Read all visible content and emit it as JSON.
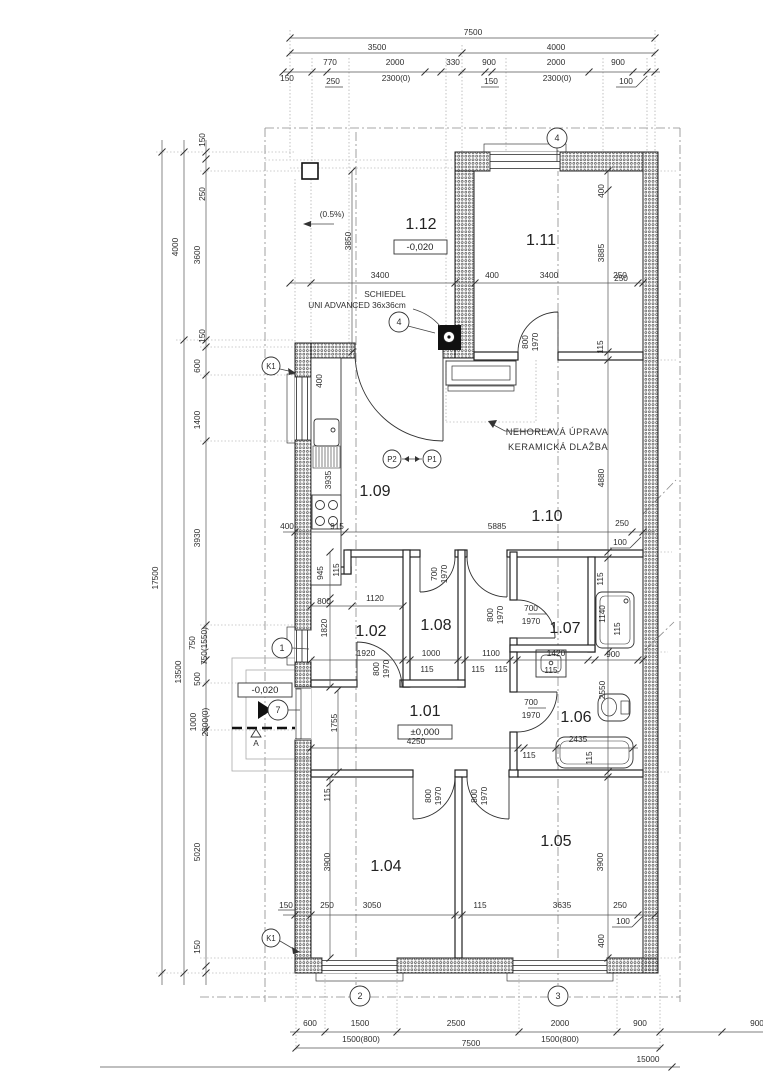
{
  "drawing": {
    "kind": "architectural floor plan",
    "levels": {
      "main": "±0,000",
      "terrace": "-0,020",
      "porch": "-0,020"
    },
    "colors": {
      "lines": "#2e2e2e",
      "walls": "#555555",
      "background": "#ffffff"
    }
  },
  "rooms": [
    {
      "number": "1.01",
      "level": "±0,000"
    },
    {
      "number": "1.02"
    },
    {
      "number": "1.04"
    },
    {
      "number": "1.05"
    },
    {
      "number": "1.06"
    },
    {
      "number": "1.07"
    },
    {
      "number": "1.08"
    },
    {
      "number": "1.09"
    },
    {
      "number": "1.10"
    },
    {
      "number": "1.11"
    },
    {
      "number": "1.12",
      "level": "-0,020"
    }
  ],
  "annotations": {
    "chimney": [
      "SCHIEDEL",
      "UNI ADVANCED 36x36cm"
    ],
    "fireproof": [
      "NEHORĽAVÁ ÚPRAVA",
      "KERAMICKÁ DLAŽBA"
    ],
    "slope": "(0.5%)",
    "section_letter": "A"
  },
  "markers": [
    {
      "n": "axis-marker-4-top",
      "t": "4",
      "x": 557,
      "y": 138
    },
    {
      "n": "detail-marker-4-chimney",
      "t": "4",
      "x": 399,
      "y": 322
    },
    {
      "n": "detail-marker-k1-top",
      "t": "K1",
      "x": 271,
      "y": 366,
      "sm": 1
    },
    {
      "n": "axis-marker-1",
      "t": "1",
      "x": 282,
      "y": 648
    },
    {
      "n": "entry-marker-7",
      "t": "7",
      "x": 278,
      "y": 710
    },
    {
      "n": "detail-marker-k1-bottom",
      "t": "K1",
      "x": 271,
      "y": 938,
      "sm": 1
    },
    {
      "n": "axis-marker-2",
      "t": "2",
      "x": 360,
      "y": 996
    },
    {
      "n": "axis-marker-3",
      "t": "3",
      "x": 558,
      "y": 996
    },
    {
      "n": "section-marker-p2",
      "t": "P2",
      "x": 392,
      "y": 459,
      "sm": 1
    },
    {
      "n": "section-marker-p1",
      "t": "P1",
      "x": 432,
      "y": 459,
      "sm": 1
    }
  ],
  "labels": [
    {
      "n": "dim-top-overall",
      "t": "7500",
      "x": 473,
      "y": 35
    },
    {
      "n": "dim-top",
      "t": "3500",
      "x": 377,
      "y": 50
    },
    {
      "n": "dim-top",
      "t": "4000",
      "x": 556,
      "y": 50
    },
    {
      "n": "dim-top",
      "t": "770",
      "x": 330,
      "y": 65
    },
    {
      "n": "dim-top",
      "t": "2000",
      "x": 395,
      "y": 65
    },
    {
      "n": "dim-top",
      "t": "330",
      "x": 453,
      "y": 65
    },
    {
      "n": "dim-top",
      "t": "900",
      "x": 489,
      "y": 65
    },
    {
      "n": "dim-top",
      "t": "2000",
      "x": 556,
      "y": 65
    },
    {
      "n": "dim-top",
      "t": "900",
      "x": 618,
      "y": 65
    },
    {
      "n": "dim-top",
      "t": "150",
      "x": 287,
      "y": 81
    },
    {
      "n": "dim-top",
      "t": "250",
      "x": 333,
      "y": 84
    },
    {
      "n": "dim-top-window",
      "t": "2300(0)",
      "x": 396,
      "y": 81
    },
    {
      "n": "dim-top",
      "t": "150",
      "x": 491,
      "y": 84
    },
    {
      "n": "dim-top-window",
      "t": "2300(0)",
      "x": 557,
      "y": 81
    },
    {
      "n": "dim-top",
      "t": "100",
      "x": 626,
      "y": 84
    },
    {
      "n": "dim-left",
      "t": "150",
      "x": 205,
      "y": 140,
      "r": -90
    },
    {
      "n": "dim-left",
      "t": "250",
      "x": 205,
      "y": 194,
      "r": -90
    },
    {
      "n": "dim-left",
      "t": "4000",
      "x": 178,
      "y": 247,
      "r": -90
    },
    {
      "n": "dim-left",
      "t": "3600",
      "x": 200,
      "y": 255,
      "r": -90
    },
    {
      "n": "dim-left",
      "t": "150",
      "x": 205,
      "y": 336,
      "r": -90
    },
    {
      "n": "dim-left",
      "t": "600",
      "x": 200,
      "y": 366,
      "r": -90
    },
    {
      "n": "dim-left",
      "t": "1400",
      "x": 200,
      "y": 420,
      "r": -90
    },
    {
      "n": "dim-left-overall",
      "t": "17500",
      "x": 158,
      "y": 578,
      "r": -90
    },
    {
      "n": "dim-left",
      "t": "13500",
      "x": 181,
      "y": 672,
      "r": -90
    },
    {
      "n": "dim-left",
      "t": "3930",
      "x": 200,
      "y": 538,
      "r": -90
    },
    {
      "n": "dim-left",
      "t": "750",
      "x": 195,
      "y": 643,
      "r": -90
    },
    {
      "n": "dim-left-window",
      "t": "750(1550)",
      "x": 207,
      "y": 646,
      "r": -90,
      "s": 7.5
    },
    {
      "n": "dim-left",
      "t": "500",
      "x": 200,
      "y": 679,
      "r": -90
    },
    {
      "n": "dim-left",
      "t": "1000",
      "x": 196,
      "y": 722,
      "r": -90
    },
    {
      "n": "dim-left-door",
      "t": "2300(0)",
      "x": 208,
      "y": 722,
      "r": -90,
      "s": 7.5
    },
    {
      "n": "dim-left",
      "t": "5020",
      "x": 200,
      "y": 852,
      "r": -90
    },
    {
      "n": "dim-left",
      "t": "150",
      "x": 200,
      "y": 947,
      "r": -90
    },
    {
      "n": "dim-right",
      "t": "400",
      "x": 604,
      "y": 191,
      "r": -90
    },
    {
      "n": "dim-right",
      "t": "3885",
      "x": 604,
      "y": 253,
      "r": -90
    },
    {
      "n": "dim-right",
      "t": "250",
      "x": 621,
      "y": 281
    },
    {
      "n": "dim-right",
      "t": "115",
      "x": 603,
      "y": 347,
      "r": -90
    },
    {
      "n": "dim-right",
      "t": "4880",
      "x": 604,
      "y": 478,
      "r": -90
    },
    {
      "n": "dim-right",
      "t": "250",
      "x": 622,
      "y": 526
    },
    {
      "n": "dim-right",
      "t": "100",
      "x": 620,
      "y": 545
    },
    {
      "n": "dim-right",
      "t": "115",
      "x": 603,
      "y": 579,
      "r": -90
    },
    {
      "n": "dim-fixture",
      "t": "1140",
      "x": 605,
      "y": 614,
      "r": -90
    },
    {
      "n": "dim-right",
      "t": "115",
      "x": 620,
      "y": 629,
      "r": -90
    },
    {
      "n": "dim-right",
      "t": "900",
      "x": 613,
      "y": 657
    },
    {
      "n": "dim-right",
      "t": "2550",
      "x": 605,
      "y": 690,
      "r": -90
    },
    {
      "n": "dim-right",
      "t": "3900",
      "x": 603,
      "y": 862,
      "r": -90
    },
    {
      "n": "dim-right",
      "t": "250",
      "x": 620,
      "y": 908
    },
    {
      "n": "dim-right",
      "t": "100",
      "x": 623,
      "y": 924
    },
    {
      "n": "dim-right",
      "t": "400",
      "x": 604,
      "y": 941,
      "r": -90
    },
    {
      "n": "slope-label",
      "t": "(0.5%)",
      "x": 332,
      "y": 217,
      "s": 7.5
    },
    {
      "n": "dim-terrace",
      "t": "3850",
      "x": 351,
      "y": 241,
      "r": -90
    },
    {
      "n": "dim-row",
      "t": "3400",
      "x": 380,
      "y": 278
    },
    {
      "n": "dim-row",
      "t": "400",
      "x": 492,
      "y": 278
    },
    {
      "n": "dim-row",
      "t": "3400",
      "x": 549,
      "y": 278
    },
    {
      "n": "dim-row",
      "t": "250",
      "x": 620,
      "y": 278
    },
    {
      "n": "chimney-label-1",
      "t": "SCHIEDEL",
      "x": 385,
      "y": 297,
      "s": 8.2
    },
    {
      "n": "chimney-label-2",
      "t": "UNI ADVANCED 36x36cm",
      "x": 357,
      "y": 308,
      "s": 8.2
    },
    {
      "n": "door-dim",
      "t": "800",
      "x": 528,
      "y": 342,
      "r": -90
    },
    {
      "n": "door-dim",
      "t": "1970",
      "x": 538,
      "y": 342,
      "r": -90
    },
    {
      "n": "fireproof-label-1",
      "t": "NEHORĽAVÁ ÚPRAVA",
      "x": 557,
      "y": 435,
      "c": "ann"
    },
    {
      "n": "fireproof-label-2",
      "t": "KERAMICKÁ DLAŽBA",
      "x": 558,
      "y": 450,
      "c": "ann"
    },
    {
      "n": "dim-kitchen",
      "t": "400",
      "x": 322,
      "y": 381,
      "r": -90
    },
    {
      "n": "dim-kitchen",
      "t": "3935",
      "x": 331,
      "y": 480,
      "r": -90
    },
    {
      "n": "dim-row",
      "t": "400",
      "x": 287,
      "y": 529
    },
    {
      "n": "dim-row",
      "t": "915",
      "x": 337,
      "y": 529
    },
    {
      "n": "dim-row",
      "t": "5885",
      "x": 497,
      "y": 529
    },
    {
      "n": "dim-mid",
      "t": "945",
      "x": 323,
      "y": 573,
      "r": -90
    },
    {
      "n": "dim-mid",
      "t": "115",
      "x": 339,
      "y": 570,
      "r": -90
    },
    {
      "n": "dim-mid",
      "t": "800",
      "x": 324,
      "y": 604
    },
    {
      "n": "dim-mid",
      "t": "1120",
      "x": 375,
      "y": 601
    },
    {
      "n": "dim-mid",
      "t": "1820",
      "x": 327,
      "y": 628,
      "r": -90
    },
    {
      "n": "door-dim",
      "t": "700",
      "x": 437,
      "y": 574,
      "r": -90
    },
    {
      "n": "door-dim",
      "t": "1970",
      "x": 447,
      "y": 574,
      "r": -90
    },
    {
      "n": "door-dim",
      "t": "800",
      "x": 493,
      "y": 615,
      "r": -90
    },
    {
      "n": "door-dim",
      "t": "1970",
      "x": 503,
      "y": 615,
      "r": -90
    },
    {
      "n": "door-dim",
      "t": "700",
      "x": 531,
      "y": 611
    },
    {
      "n": "door-dim",
      "t": "1970",
      "x": 531,
      "y": 624
    },
    {
      "n": "dim-row2",
      "t": "1920",
      "x": 366,
      "y": 656
    },
    {
      "n": "door-dim",
      "t": "800",
      "x": 379,
      "y": 669,
      "r": -90
    },
    {
      "n": "door-dim",
      "t": "1970",
      "x": 389,
      "y": 669,
      "r": -90
    },
    {
      "n": "dim-row2",
      "t": "1000",
      "x": 431,
      "y": 656
    },
    {
      "n": "dim-row2",
      "t": "115",
      "x": 427,
      "y": 672
    },
    {
      "n": "dim-row2",
      "t": "1100",
      "x": 491,
      "y": 656
    },
    {
      "n": "dim-row2",
      "t": "115",
      "x": 478,
      "y": 672
    },
    {
      "n": "dim-row2",
      "t": "115",
      "x": 501,
      "y": 672
    },
    {
      "n": "dim-row2",
      "t": "1420",
      "x": 556,
      "y": 656
    },
    {
      "n": "dim-row2",
      "t": "115",
      "x": 551,
      "y": 673
    },
    {
      "n": "dim-mid",
      "t": "1755",
      "x": 337,
      "y": 723,
      "r": -90
    },
    {
      "n": "door-dim",
      "t": "700",
      "x": 531,
      "y": 705
    },
    {
      "n": "door-dim",
      "t": "1970",
      "x": 531,
      "y": 718
    },
    {
      "n": "dim-row3",
      "t": "4250",
      "x": 416,
      "y": 744
    },
    {
      "n": "dim-row3",
      "t": "115",
      "x": 529,
      "y": 758
    },
    {
      "n": "dim-fixture",
      "t": "2435",
      "x": 578,
      "y": 742
    },
    {
      "n": "dim-row3",
      "t": "115",
      "x": 592,
      "y": 758,
      "r": -90
    },
    {
      "n": "door-dim",
      "t": "800",
      "x": 431,
      "y": 796,
      "r": -90
    },
    {
      "n": "door-dim",
      "t": "1970",
      "x": 441,
      "y": 796,
      "r": -90
    },
    {
      "n": "door-dim",
      "t": "800",
      "x": 477,
      "y": 796,
      "r": -90
    },
    {
      "n": "door-dim",
      "t": "1970",
      "x": 487,
      "y": 796,
      "r": -90
    },
    {
      "n": "dim-bottomroom",
      "t": "115",
      "x": 330,
      "y": 795,
      "r": -90
    },
    {
      "n": "dim-bottomroom",
      "t": "3900",
      "x": 330,
      "y": 862,
      "r": -90
    },
    {
      "n": "dim-row4",
      "t": "150",
      "x": 286,
      "y": 908
    },
    {
      "n": "dim-row4",
      "t": "250",
      "x": 327,
      "y": 908
    },
    {
      "n": "dim-row4",
      "t": "3050",
      "x": 372,
      "y": 908
    },
    {
      "n": "dim-row4",
      "t": "115",
      "x": 480,
      "y": 908
    },
    {
      "n": "dim-row4",
      "t": "3635",
      "x": 562,
      "y": 908
    },
    {
      "n": "dim-bottom",
      "t": "600",
      "x": 310,
      "y": 1026
    },
    {
      "n": "dim-bottom",
      "t": "1500",
      "x": 360,
      "y": 1026
    },
    {
      "n": "dim-bottom",
      "t": "2500",
      "x": 456,
      "y": 1026
    },
    {
      "n": "dim-bottom",
      "t": "2000",
      "x": 560,
      "y": 1026
    },
    {
      "n": "dim-bottom",
      "t": "900",
      "x": 640,
      "y": 1026
    },
    {
      "n": "dim-bottom",
      "t": "900",
      "x": 757,
      "y": 1026
    },
    {
      "n": "dim-bottom-window",
      "t": "1500(800)",
      "x": 361,
      "y": 1042
    },
    {
      "n": "dim-bottom-window",
      "t": "1500(800)",
      "x": 560,
      "y": 1042
    },
    {
      "n": "dim-bottom",
      "t": "7500",
      "x": 471,
      "y": 1046
    },
    {
      "n": "dim-bottom-overall",
      "t": "15000",
      "x": 648,
      "y": 1062
    },
    {
      "n": "room-label-1-12",
      "t": "1.12",
      "x": 421,
      "y": 229,
      "c": "room"
    },
    {
      "n": "level-label-terrace",
      "t": "-0,020",
      "x": 420,
      "y": 250,
      "c": "lvl"
    },
    {
      "n": "room-label-1-11",
      "t": "1.11",
      "x": 541,
      "y": 245,
      "c": "room"
    },
    {
      "n": "room-label-1-09",
      "t": "1.09",
      "x": 375,
      "y": 496,
      "c": "room"
    },
    {
      "n": "room-label-1-10",
      "t": "1.10",
      "x": 547,
      "y": 521,
      "c": "room"
    },
    {
      "n": "room-label-1-02",
      "t": "1.02",
      "x": 371,
      "y": 636,
      "c": "room"
    },
    {
      "n": "room-label-1-08",
      "t": "1.08",
      "x": 436,
      "y": 630,
      "c": "room"
    },
    {
      "n": "room-label-1-07",
      "t": "1.07",
      "x": 565,
      "y": 633,
      "c": "room"
    },
    {
      "n": "room-label-1-01",
      "t": "1.01",
      "x": 425,
      "y": 716,
      "c": "room"
    },
    {
      "n": "level-label-main",
      "t": "±0,000",
      "x": 425,
      "y": 735,
      "c": "lvl"
    },
    {
      "n": "room-label-1-06",
      "t": "1.06",
      "x": 576,
      "y": 722,
      "c": "room"
    },
    {
      "n": "room-label-1-04",
      "t": "1.04",
      "x": 386,
      "y": 871,
      "c": "room"
    },
    {
      "n": "room-label-1-05",
      "t": "1.05",
      "x": 556,
      "y": 846,
      "c": "room"
    },
    {
      "n": "level-label-porch",
      "t": "-0,020",
      "x": 265,
      "y": 693,
      "c": "lvl"
    },
    {
      "n": "section-letter",
      "t": "A",
      "x": 256,
      "y": 746,
      "s": 9
    }
  ]
}
